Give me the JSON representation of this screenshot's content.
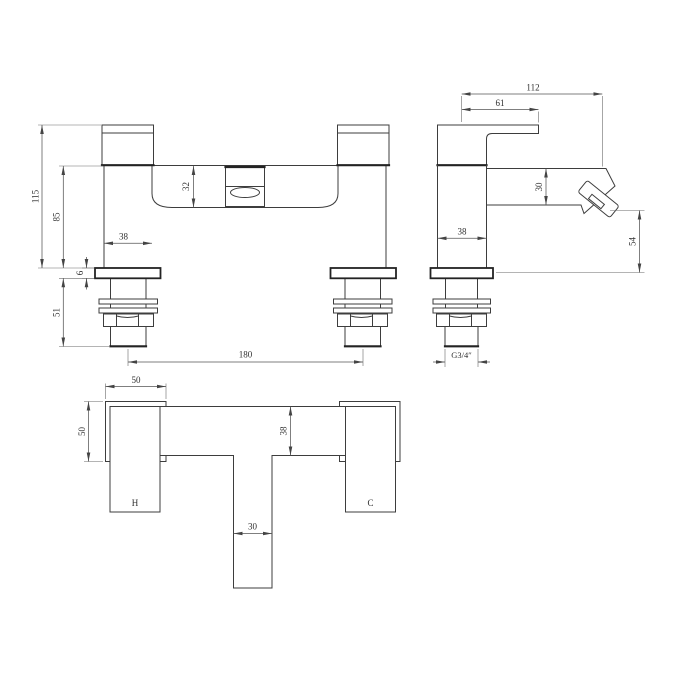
{
  "front_view": {
    "overall_height": "115",
    "deck_to_top": "85",
    "shank_length": "51",
    "base_plate_thickness": "6",
    "body_width": "38",
    "spout_block_height": "32",
    "tap_centres": "180"
  },
  "side_view": {
    "overall_depth": "112",
    "handle_projection": "61",
    "spout_height": "30",
    "body_depth": "38",
    "outlet_to_base": "54",
    "connection_thread": "G3/4″"
  },
  "plan_view": {
    "handle_width": "50",
    "handle_depth": "50",
    "body_depth": "38",
    "spout_width": "30",
    "hot_label": "H",
    "cold_label": "C"
  }
}
